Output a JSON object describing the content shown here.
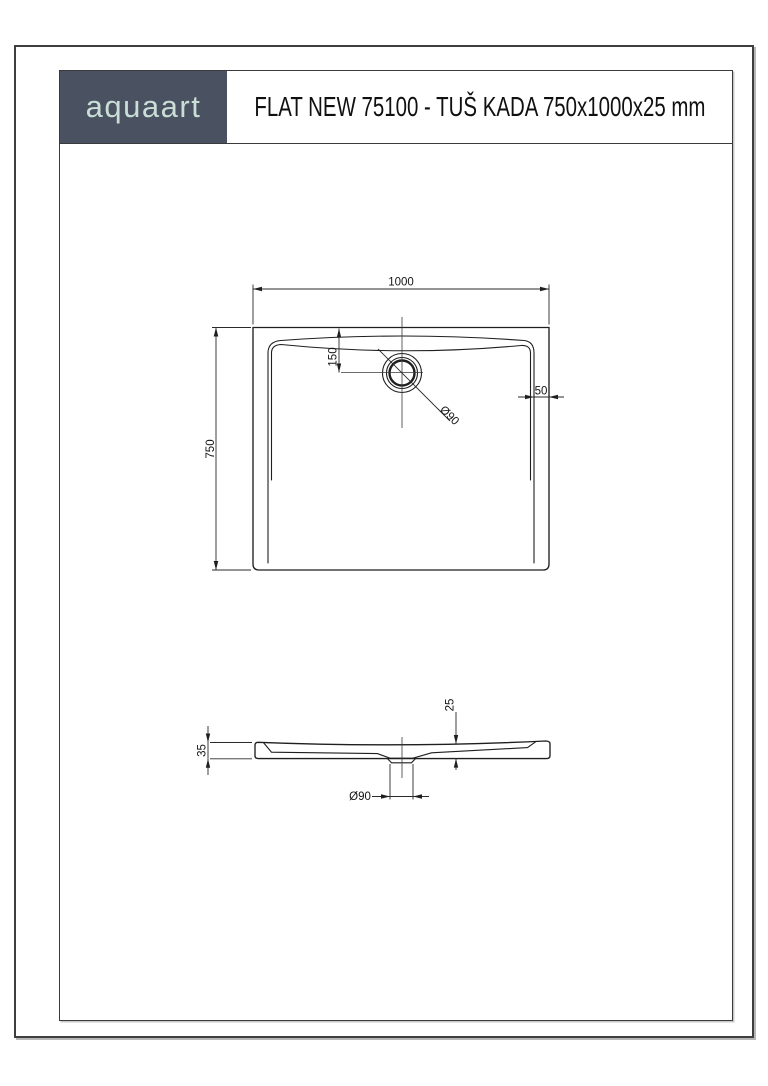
{
  "header": {
    "logo_text": "aquaart",
    "title": "FLAT NEW 75100 - TUŠ KADA 750x1000x25 mm"
  },
  "colors": {
    "logo_background": "#4a5262",
    "logo_text_color": "#c9ded6",
    "line_color": "#1f1f1f",
    "border_color": "#3e3e3e"
  },
  "drawing": {
    "plan_view": {
      "name": "top view of shower tray",
      "dim_width": "1000",
      "dim_height": "750",
      "dim_drain_from_top": "150",
      "dim_rim_right": "50",
      "dim_drain_diameter": "Ø90"
    },
    "section_view": {
      "name": "side section of shower tray",
      "dim_edge_height": "35",
      "dim_tray_height": "25",
      "dim_drain_diameter": "Ø90"
    }
  }
}
